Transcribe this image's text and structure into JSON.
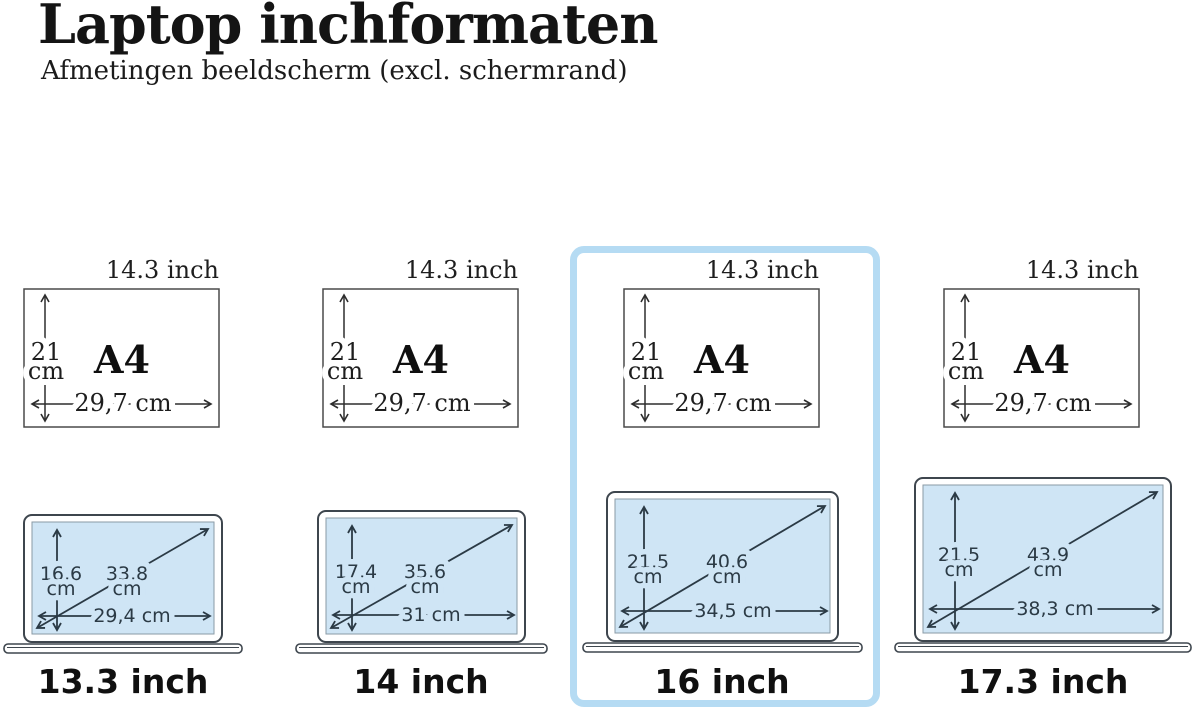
{
  "header": {
    "title": "Laptop inchformaten",
    "subtitle": "Afmetingen beeldscherm (excl. schermrand)"
  },
  "a4_reference": {
    "diagonal": "14.3 inch",
    "name": "A4",
    "height_value": "21",
    "height_unit": "cm",
    "width": "29,7 cm"
  },
  "laptops": [
    {
      "size": "13.3 inch",
      "height_value": "16,6",
      "height_unit": "cm",
      "diagonal_value": "33,8",
      "diagonal_unit": "cm",
      "width": "29,4 cm",
      "highlighted": false
    },
    {
      "size": "14 inch",
      "height_value": "17,4",
      "height_unit": "cm",
      "diagonal_value": "35,6",
      "diagonal_unit": "cm",
      "width": "31 cm",
      "highlighted": false
    },
    {
      "size": "16 inch",
      "height_value": "21,5",
      "height_unit": "cm",
      "diagonal_value": "40,6",
      "diagonal_unit": "cm",
      "width": "34,5 cm",
      "highlighted": true
    },
    {
      "size": "17.3 inch",
      "height_value": "21,5",
      "height_unit": "cm",
      "diagonal_value": "43,9",
      "diagonal_unit": "cm",
      "width": "38,3 cm",
      "highlighted": false
    }
  ],
  "colors": {
    "screen_fill": "#cfe5f5",
    "highlight_border": "#b5dbf3",
    "laptop_arrow": "#2b3a45",
    "a4_arrow": "#2d2d2d",
    "text": "#141414"
  }
}
